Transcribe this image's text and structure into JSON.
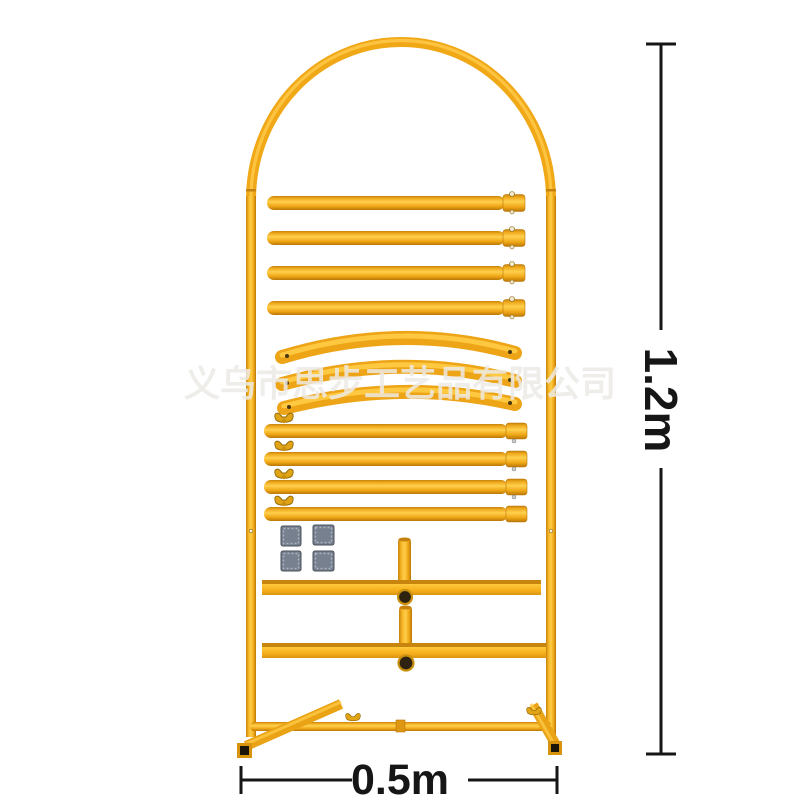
{
  "photo": {
    "type": "product-photo",
    "subject": "yellow metal arch stand frame kit with disassembled tube parts",
    "background_color": "#FFFFFF"
  },
  "watermark": {
    "text": "义乌市思步工艺品有限公司",
    "color": "#ECEAE5"
  },
  "dimensions": {
    "height": {
      "label": "1.2m"
    },
    "width": {
      "label": "0.5m"
    }
  },
  "colors": {
    "tube_yellow": "#F2AC1C",
    "tube_highlight": "#FFCD49",
    "tube_shadow": "#C07A09",
    "bar_bevel": "#C8850E",
    "clip_gray": "#76808F",
    "tube_opening_dark": "#2E2310",
    "annotation_black": "#161616"
  },
  "parts": {
    "arch_frame_count": 1,
    "straight_tube_count": 4,
    "curved_tube_count": 3,
    "wingnut_tube_count": 4,
    "gray_clip_count": 4,
    "t_crossbar_assembly_count": 2
  }
}
